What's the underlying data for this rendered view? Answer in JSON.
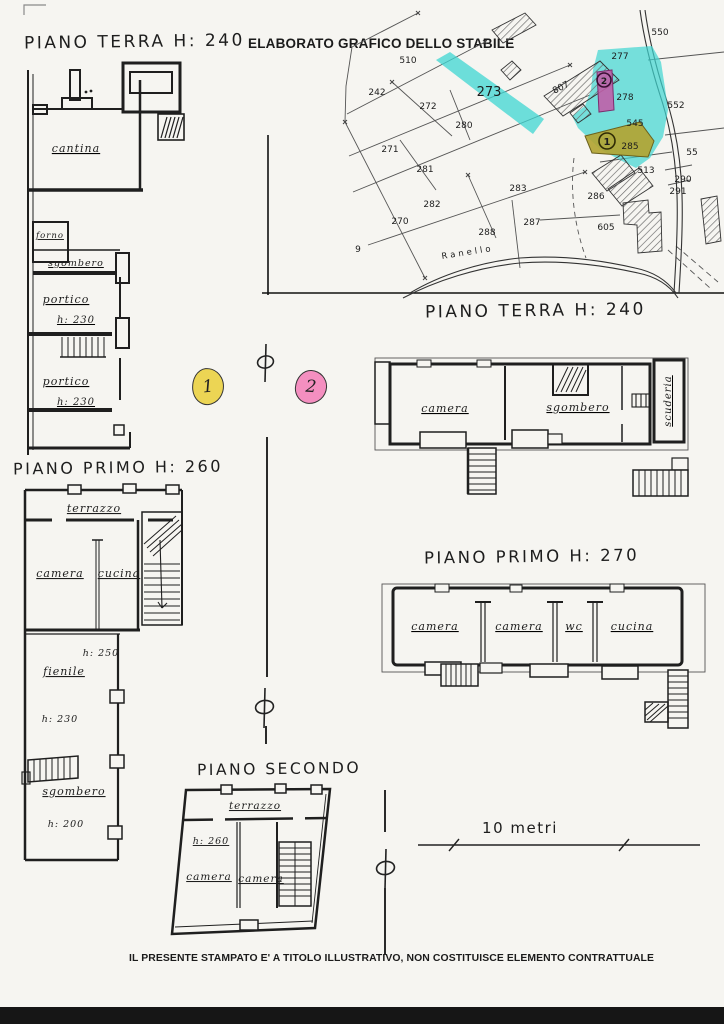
{
  "footer": {
    "disclaimer": "IL PRESENTE STAMPATO E' A TITOLO ILLUSTRATIVO, NON COSTITUISCE ELEMENTO CONTRATTUALE"
  },
  "scale_bar": {
    "label": "10 metri"
  },
  "section_markers": {
    "symbol": "ϕ",
    "marker_1": "1",
    "marker_2": "2"
  },
  "map": {
    "title": "ELABORATO GRAFICO DELLO STABILE",
    "street_label": "Ranello",
    "building_number": "807",
    "stray_label": "9",
    "circled_2": "2",
    "circled_1": "1",
    "highlight_colors": {
      "cyan": "#3ed6d2",
      "magenta": "#c05fa9",
      "olive": "#b2a433",
      "marker_yellow": "#ecd554",
      "marker_pink": "#f48fc0"
    },
    "parcels": [
      {
        "id": "510"
      },
      {
        "id": "242"
      },
      {
        "id": "272"
      },
      {
        "id": "280"
      },
      {
        "id": "271"
      },
      {
        "id": "281"
      },
      {
        "id": "282"
      },
      {
        "id": "270"
      },
      {
        "id": "283"
      },
      {
        "id": "287"
      },
      {
        "id": "288"
      },
      {
        "id": "286"
      },
      {
        "id": "605"
      },
      {
        "id": "550"
      },
      {
        "id": "277"
      },
      {
        "id": "278"
      },
      {
        "id": "552"
      },
      {
        "id": "545"
      },
      {
        "id": "513"
      },
      {
        "id": "290"
      },
      {
        "id": "291"
      },
      {
        "id": "55"
      },
      {
        "id": "285"
      },
      {
        "id": "273"
      }
    ]
  },
  "plans": {
    "terra_left": {
      "title": "PIANO TERRA  H: 240",
      "rooms": {
        "cantina": "cantina",
        "forno": "forno",
        "sgombero": "sgombero",
        "portico_1": "portico",
        "portico_1_height": "h: 230",
        "portico_2": "portico",
        "portico_2_height": "h: 230"
      }
    },
    "terra_right": {
      "title": "PIANO TERRA  H: 240",
      "rooms": {
        "camera": "camera",
        "sgombero": "sgombero",
        "scuderia": "scuderia"
      }
    },
    "primo_left": {
      "title": "PIANO PRIMO  H: 260",
      "rooms": {
        "terrazzo": "terrazzo",
        "camera": "camera",
        "cucina": "cucina",
        "height_250": "h: 250",
        "fienile": "fienile",
        "height_230": "h: 230",
        "sgombero": "sgombero",
        "height_200": "h: 200"
      }
    },
    "primo_right": {
      "title": "PIANO PRIMO  H: 270",
      "rooms": {
        "camera_1": "camera",
        "camera_2": "camera",
        "wc": "wc",
        "cucina": "cucina"
      }
    },
    "secondo": {
      "title": "PIANO SECONDO",
      "rooms": {
        "terrazzo": "terrazzo",
        "height_260": "h: 260",
        "camera_1": "camera",
        "camera_2": "camera"
      }
    }
  }
}
